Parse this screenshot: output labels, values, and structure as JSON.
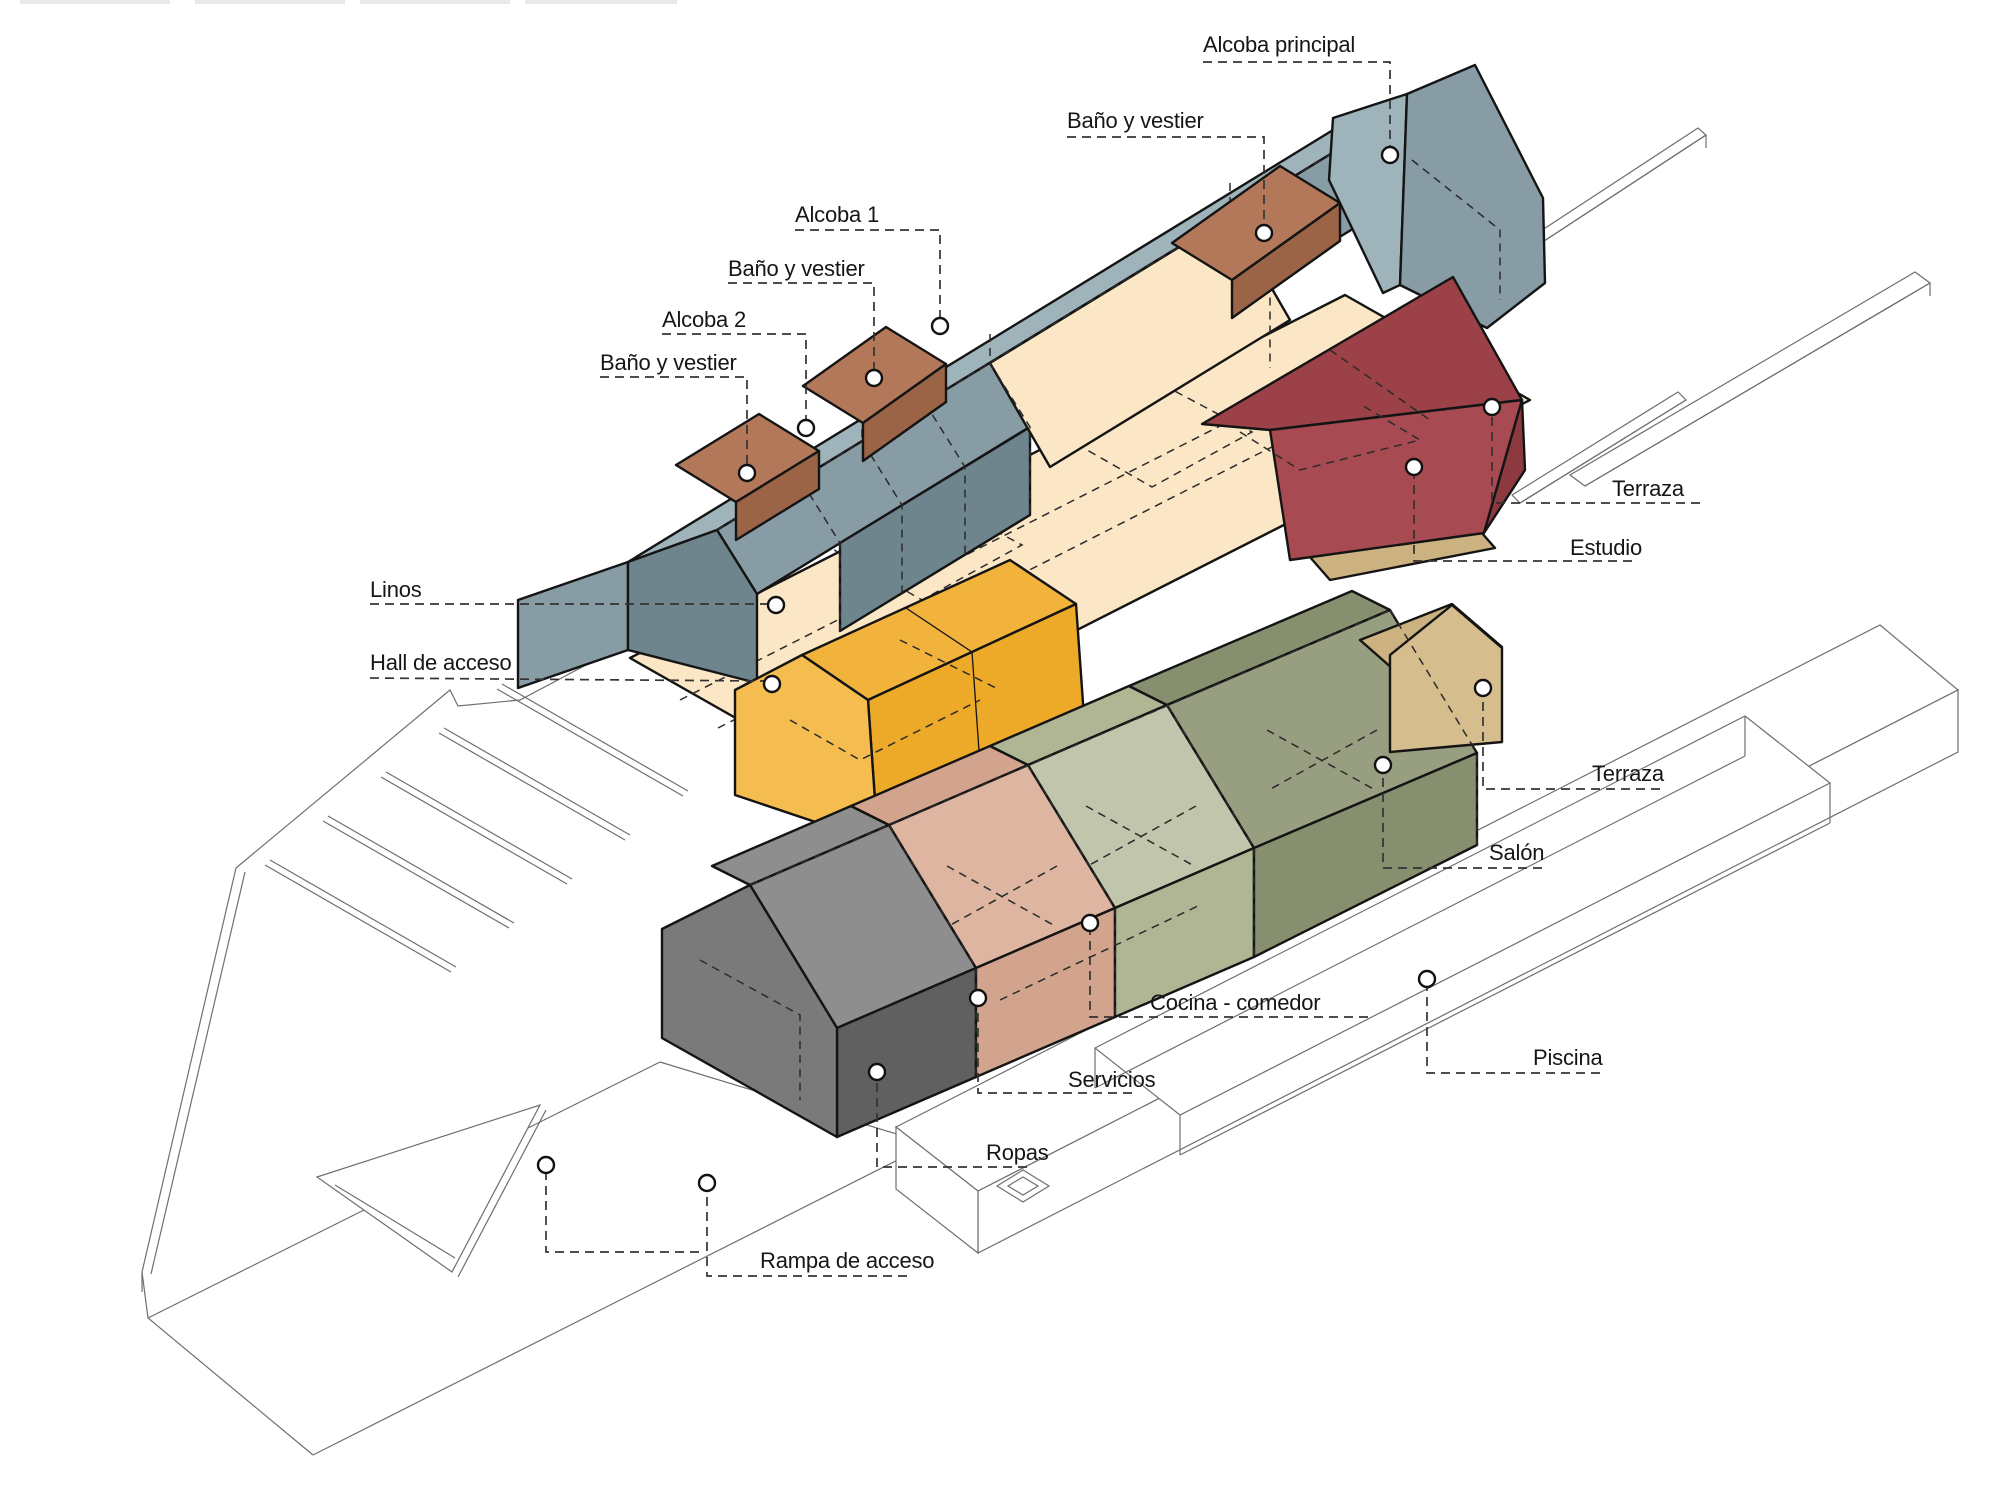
{
  "diagram": {
    "kind": "exploded-axonometric-architecture-diagram",
    "language": "es"
  },
  "palette": {
    "surface": "#ffffff",
    "artifact_gray": "#e9e9e9",
    "blue_light": "#9FB3BA",
    "blue_mid": "#879CA4",
    "blue_dark": "#6E858E",
    "brown_top": "#B3785A",
    "brown_front": "#9C6446",
    "cream": "#FBE7C5",
    "red_top": "#9C4147",
    "red_front": "#A74A51",
    "red_side": "#8C3A40",
    "yellow_gable": "#F5BC4F",
    "yellow_roof": "#F2B33C",
    "yellow_wall": "#EDA928",
    "gray_gable": "#7A7A7A",
    "gray_roof": "#8E8E8E",
    "gray_wall": "#606060",
    "salmon_roof": "#DDB5A1",
    "salmon_wall": "#D2A48D",
    "green_light_roof": "#C0C5AB",
    "green_light_wall": "#B0B694",
    "green_dark_roof": "#979F80",
    "green_dark_wall": "#87906E",
    "khaki_gable": "#D6BD8E",
    "khaki_top": "#CCB281",
    "marker": "#ffffff"
  },
  "labels": {
    "alcoba_principal": "Alcoba principal",
    "bano_vestier": "Baño y vestier",
    "alcoba_1": "Alcoba 1",
    "alcoba_2": "Alcoba 2",
    "linos": "Linos",
    "hall_de_acceso": "Hall de acceso",
    "terraza": "Terraza",
    "estudio": "Estudio",
    "salon": "Salón",
    "cocina_comedor": "Cocina - comedor",
    "servicios": "Servicios",
    "ropas": "Ropas",
    "piscina": "Piscina",
    "rampa_de_acceso": "Rampa de acceso"
  }
}
